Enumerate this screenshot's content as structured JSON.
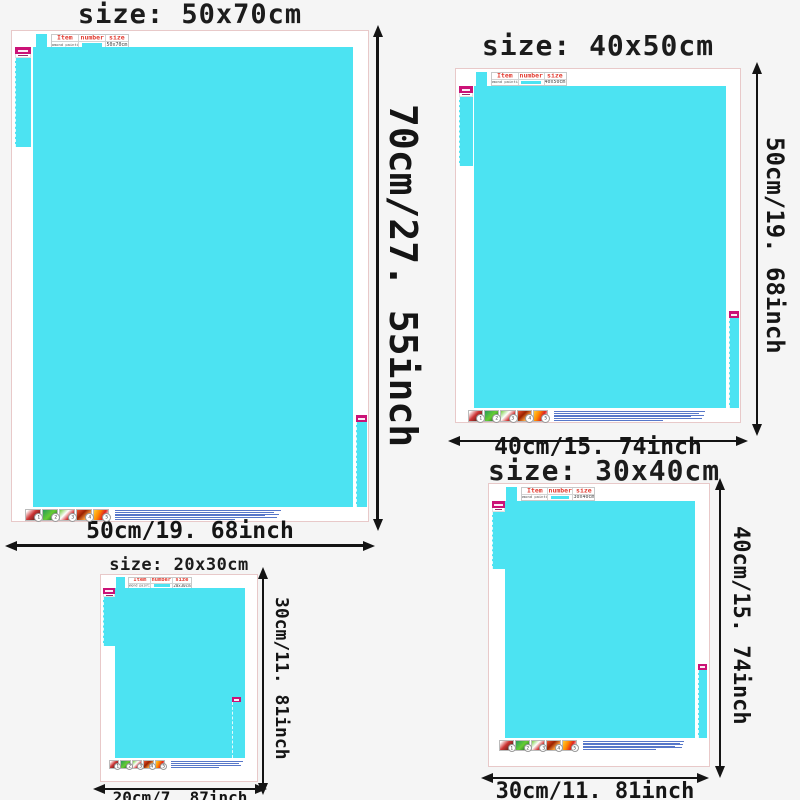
{
  "page": {
    "background": "#f5f5f5"
  },
  "colors": {
    "canvas_cyan": "#4ce3f2",
    "tag_magenta": "#cb1277",
    "table_header_red": "#e23b30",
    "arrow_black": "#141414",
    "frame_border_pink": "#e8c9c9",
    "instruction_text_blue": "#3a5fc0"
  },
  "table": {
    "headers": [
      "Item",
      "number",
      "size"
    ],
    "item_value": "Diamond painting"
  },
  "steps": [
    "1",
    "2",
    "3",
    "4",
    "5"
  ],
  "panels": [
    {
      "id": "50x70",
      "title": "size: 50x70cm",
      "table_size": "50x70cm",
      "v_label": "70cm/27. 55inch",
      "h_label": "50cm/19. 68inch"
    },
    {
      "id": "40x50",
      "title": "size: 40x50cm",
      "table_size": "40x50cm",
      "v_label": "50cm/19. 68inch",
      "h_label": "40cm/15. 74inch"
    },
    {
      "id": "20x30",
      "title": "size: 20x30cm",
      "table_size": "20x30cm",
      "v_label": "30cm/11. 81inch",
      "h_label": "20cm/7. 87inch"
    },
    {
      "id": "30x40",
      "title": "size: 30x40cm",
      "table_size": "30x40cm",
      "v_label": "40cm/15. 74inch",
      "h_label": "30cm/11. 81inch"
    }
  ]
}
